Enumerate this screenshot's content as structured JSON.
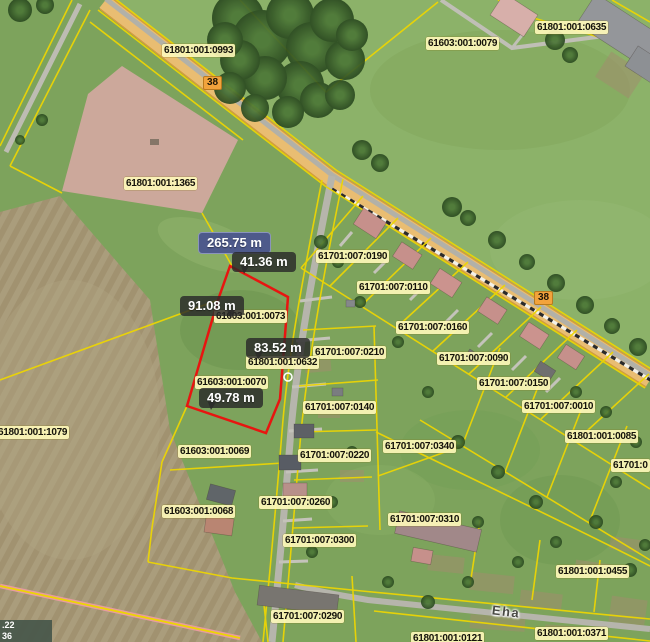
{
  "map": {
    "parcel_labels": [
      {
        "text": "61801:001:0993"
      },
      {
        "text": "61603:001:0079"
      },
      {
        "text": "61801:001:0635"
      },
      {
        "text": "61801:001:1365"
      },
      {
        "text": "61701:007:0190"
      },
      {
        "text": "61701:007:0110"
      },
      {
        "text": "61603:001:0073"
      },
      {
        "text": "61701:007:0160"
      },
      {
        "text": "61701:007:0210"
      },
      {
        "text": "61701:007:0090"
      },
      {
        "text": "61801:001:0632"
      },
      {
        "text": "61701:007:0150"
      },
      {
        "text": "61603:001:0070"
      },
      {
        "text": "61701:007:0140"
      },
      {
        "text": "61701:007:0010"
      },
      {
        "text": "61801:001:1079"
      },
      {
        "text": "61801:001:0085"
      },
      {
        "text": "61603:001:0069"
      },
      {
        "text": "61701:007:0340"
      },
      {
        "text": "61701:007:0220"
      },
      {
        "text": "61701:0"
      },
      {
        "text": "61701:007:0260"
      },
      {
        "text": "61603:001:0068"
      },
      {
        "text": "61701:007:0310"
      },
      {
        "text": "61701:007:0300"
      },
      {
        "text": "61801:001:0455"
      },
      {
        "text": "61701:007:0290"
      },
      {
        "text": "61801:001:0371"
      },
      {
        "text": "61801:001:0121"
      }
    ],
    "road_badges": [
      {
        "text": "38"
      },
      {
        "text": "38"
      }
    ],
    "street_name": "Eha",
    "measurements": {
      "total": "265.75 m",
      "top": "41.36 m",
      "left": "91.08 m",
      "middle": "83.52 m",
      "bottom": "49.78 m"
    },
    "coordinate_readout": {
      "line1": ".22",
      "line2": "36"
    },
    "colors": {
      "selected_parcel": "#e81510",
      "boundary": "#ecd504",
      "total_badge_bg": "#4e5a8b",
      "segment_badge_bg": "rgba(42,42,42,0.82)",
      "label_bg": "#fdf7b9",
      "road_badge_bg": "#f2a33c"
    }
  }
}
